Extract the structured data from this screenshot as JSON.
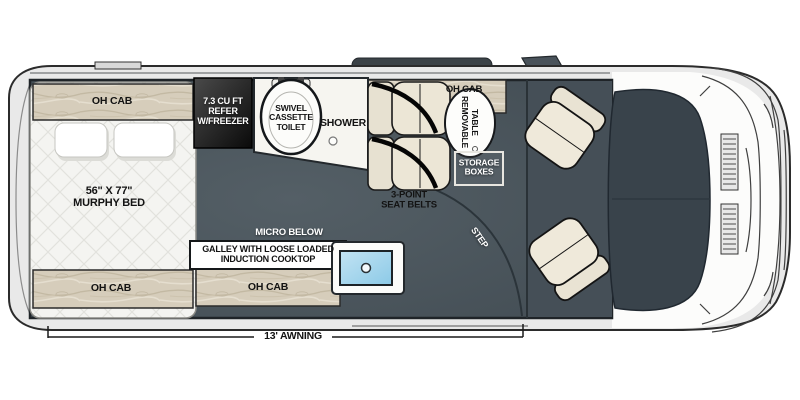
{
  "floorplan": {
    "bedroom": {
      "oh_cab_top": "OH CAB",
      "oh_cab_bottom": "OH CAB",
      "bed_size": "56\" X 77\"",
      "bed_name": "MURPHY BED"
    },
    "refrigerator": {
      "line1": "7.3 CU FT",
      "line2": "REFER",
      "line3": "W/FREEZER"
    },
    "bath": {
      "toilet_line1": "SWIVEL",
      "toilet_line2": "CASSETTE",
      "toilet_line3": "TOILET",
      "shower": "SHOWER"
    },
    "dinette": {
      "oh_cab": "OH CAB",
      "table_line1": "REMOVABLE",
      "table_line2": "TABLE",
      "storage_line1": "STORAGE",
      "storage_line2": "BOXES",
      "belts_line1": "3-POINT",
      "belts_line2": "SEAT BELTS"
    },
    "galley": {
      "micro": "MICRO BELOW",
      "line1": "GALLEY WITH LOOSE LOADED",
      "line2": "INDUCTION COOKTOP",
      "oh_cab": "OH CAB"
    },
    "entry": {
      "step": "STEP"
    },
    "exterior": {
      "awning": "13' AWNING"
    },
    "colors": {
      "floor": "#4b565d",
      "cab_floor": "#454f57",
      "dashboard": "#39434b",
      "wood_cabinet": "#d6cdbb",
      "sink_blue": "#9fd4ec",
      "refrigerator_dark": "#1c1c1c",
      "seat_cream": "#ece6d6",
      "fixture_white": "#f6f5f0"
    }
  }
}
